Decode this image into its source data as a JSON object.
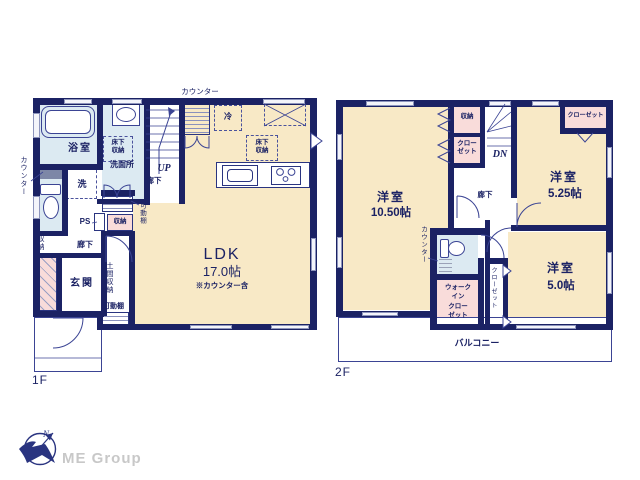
{
  "palette": {
    "wall_navy": "#1b2264",
    "room_cream": "#f8e9c6",
    "wet_area_blue": "#dceaf2",
    "closet_pink": "#f9dcda",
    "line_navy": "#3b4494",
    "logo_gray": "#c8c8c8"
  },
  "floor1": {
    "label": "1F",
    "counter_top": "カウンター",
    "counter_left": "カウンター",
    "bath": "浴室",
    "underfloor_storage": "床下\n収納",
    "washroom": "洗面所",
    "washer": "洗",
    "toilet_storage": "収納",
    "hall_lower": "廊下",
    "hall_stairs": "廊下",
    "ps": "PS",
    "hall_storage": "収納",
    "movable_shelf": "可動棚",
    "up": "UP",
    "fridge": "冷",
    "underfloor_storage_ldk": "床下\n収納",
    "ldk_name": "LDK",
    "ldk_size": "17.0帖",
    "ldk_note": "※カウンター含",
    "entrance": "玄関",
    "doma_storage": "土間収納",
    "doma_shelf": "可動棚"
  },
  "floor2": {
    "label": "2F",
    "bedroom1_name": "洋室",
    "bedroom1_size": "10.50帖",
    "storage": "収納",
    "closet_mid": "クロー\nゼット",
    "dn": "DN",
    "hall": "廊下",
    "closet_top_right": "クローゼット",
    "bedroom2_name": "洋室",
    "bedroom2_size": "5.25帖",
    "counter": "カウンター",
    "wic": "ウォーク\nイン\nクロー\nゼット",
    "closet_side": "クローゼット",
    "bedroom3_name": "洋室",
    "bedroom3_size": "5.0帖",
    "balcony": "バルコニー"
  },
  "logo": {
    "company": "ME Group",
    "north": "N"
  }
}
